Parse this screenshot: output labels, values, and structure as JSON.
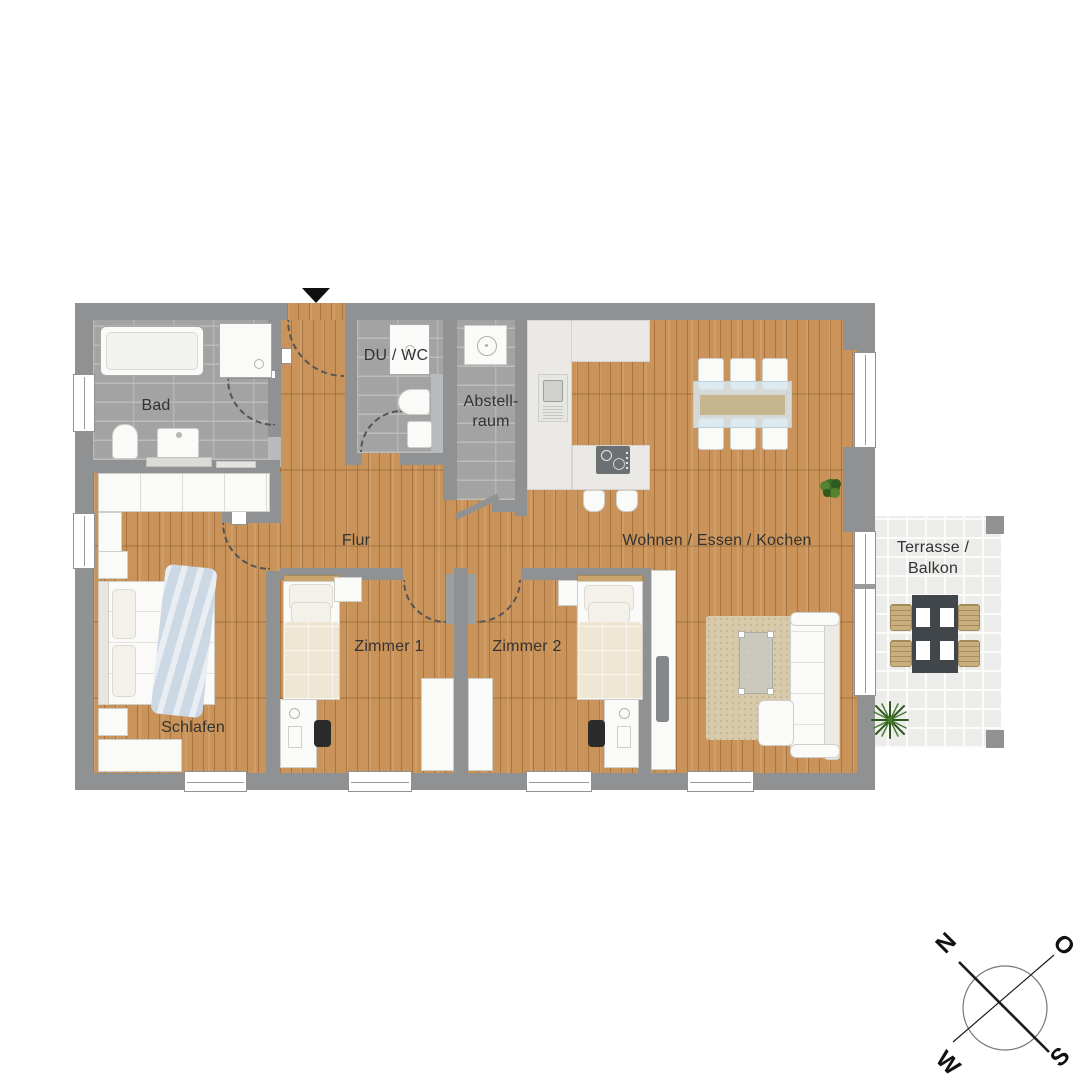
{
  "rooms": {
    "bad": {
      "label": "Bad"
    },
    "du_wc": {
      "label": "DU / WC"
    },
    "abstellraum": {
      "line1": "Abstell-",
      "line2": "raum"
    },
    "flur": {
      "label": "Flur"
    },
    "wohnen": {
      "label": "Wohnen / Essen / Kochen"
    },
    "zimmer1": {
      "label": "Zimmer 1"
    },
    "zimmer2": {
      "label": "Zimmer 2"
    },
    "schlafen": {
      "label": "Schlafen"
    },
    "terrasse": {
      "line1": "Terrasse /",
      "line2": "Balkon"
    }
  },
  "compass": {
    "north": "N",
    "east": "O",
    "south": "S",
    "west": "W"
  },
  "colors": {
    "wood_floor": "#c9935a",
    "wall_gray": "#8f9193",
    "tile_gray": "#a3a3a3",
    "kitchen_counter": "#eae9e5",
    "terrace_tile": "#ececea",
    "accent_blue": "#ccd9e4",
    "terrace_table": "#41464b",
    "plant_green": "#3f6d2a",
    "entrance_arrow": "#101010"
  }
}
